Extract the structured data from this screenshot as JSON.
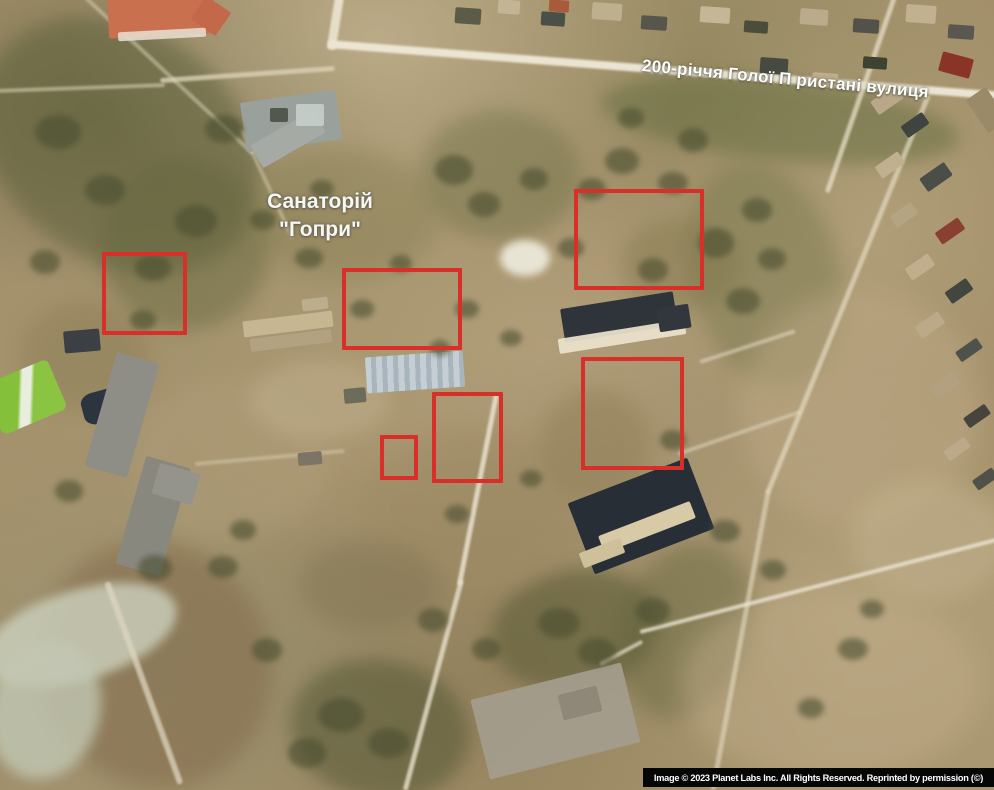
{
  "map": {
    "street_label": "200-річчя Голої П ристані вулиця",
    "place_label_line1": "Санаторій",
    "place_label_line2": "\"Гопри\"",
    "credit": "Image © 2023 Planet Labs Inc. All Rights Reserved. Reprinted by permission (©)"
  },
  "annotations": {
    "color": "#d92f29",
    "boxes": [
      {
        "x": 102,
        "y": 252,
        "w": 85,
        "h": 83
      },
      {
        "x": 342,
        "y": 268,
        "w": 120,
        "h": 82
      },
      {
        "x": 574,
        "y": 189,
        "w": 130,
        "h": 101
      },
      {
        "x": 432,
        "y": 392,
        "w": 71,
        "h": 91
      },
      {
        "x": 380,
        "y": 435,
        "w": 38,
        "h": 45
      },
      {
        "x": 581,
        "y": 357,
        "w": 103,
        "h": 113
      }
    ]
  }
}
